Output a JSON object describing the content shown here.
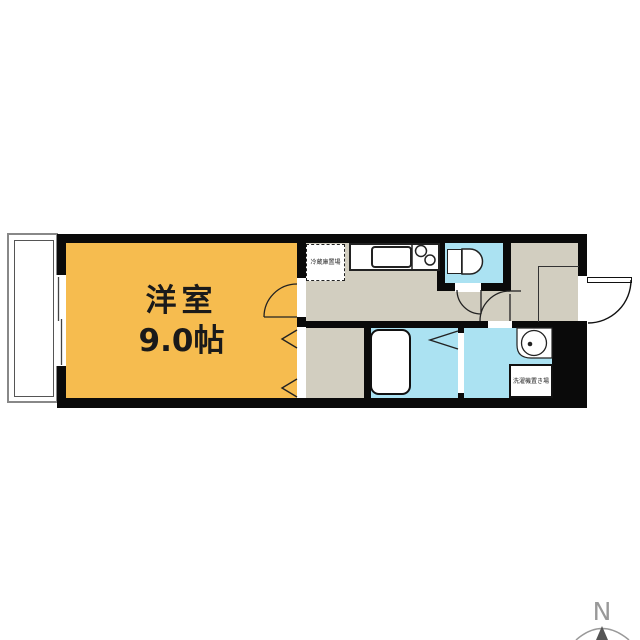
{
  "floorplan": {
    "title_room": {
      "name": "洋室",
      "size": "9.0帖"
    },
    "labels": {
      "refrigerator": "冷蔵庫置場",
      "washing_machine": "洗濯機置き場"
    },
    "compass": {
      "north": "N"
    },
    "colors": {
      "wall": "#0a0a0a",
      "room": "#f6bc4f",
      "water": "#abe2f2",
      "floor": "#d2cec0",
      "line": "#888888",
      "ink": "#1a1a1a"
    }
  }
}
